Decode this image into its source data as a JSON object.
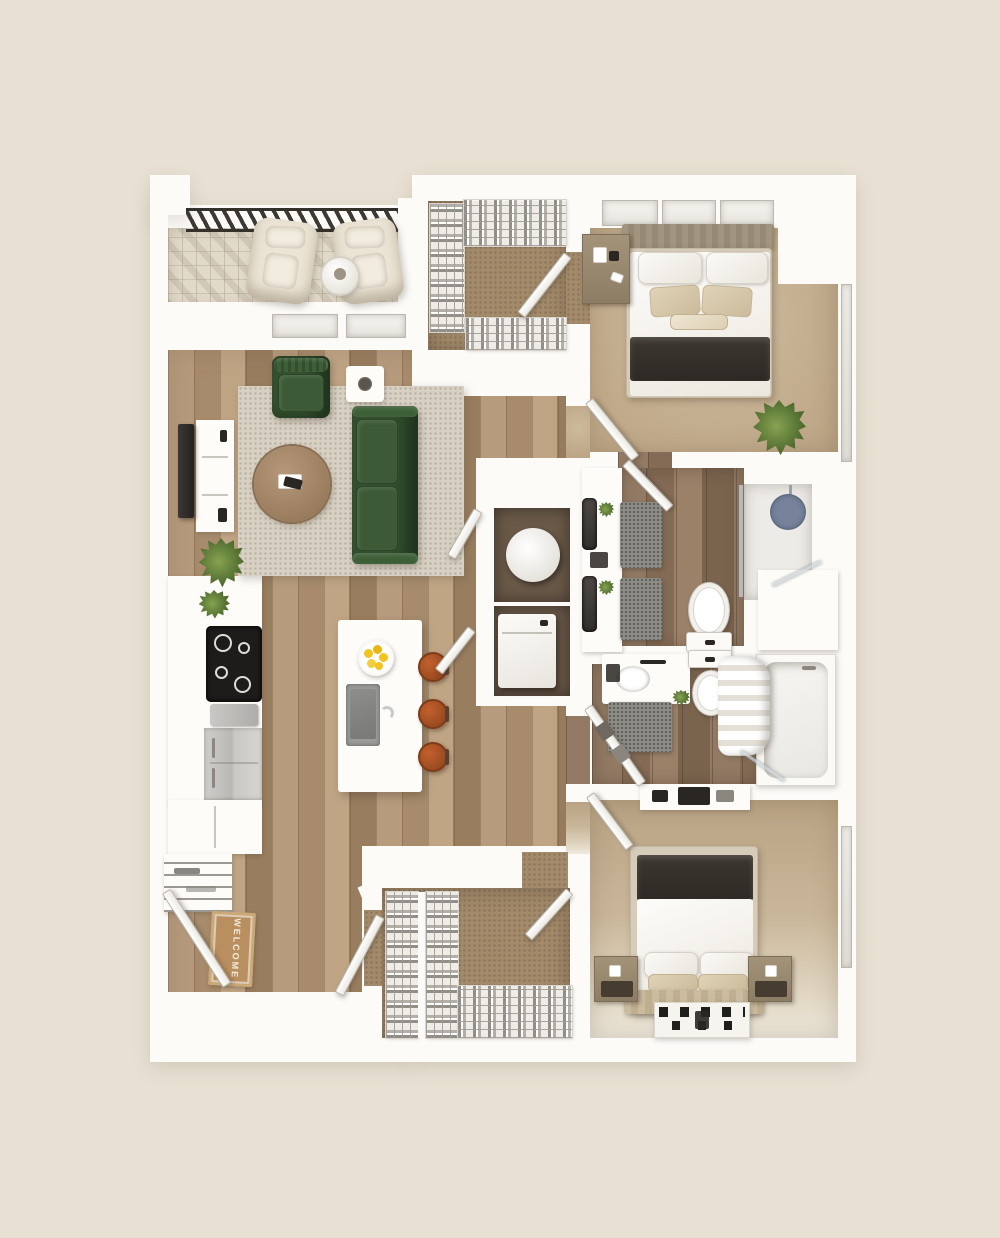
{
  "scene": {
    "type": "3d_floor_plan",
    "unit": "two-bedroom two-bath apartment with balcony"
  },
  "entry": {
    "mat_text": "WELCOME"
  },
  "palette": {
    "background": "#e8e1d3",
    "wall": "#fcfbf8",
    "wood_mid": "#ac9072",
    "tile_mid": "#8c7460",
    "balcony": "#e2dac9",
    "carpet_bed": "#bda686",
    "carpet_closet": "#a38a6b",
    "rug": "#d8d1c3",
    "sofa": "#33502f",
    "stool": "#9a4a20",
    "lemon": "#f1c41f",
    "blanket": "#2e2924",
    "mat_brown": "#b98f60",
    "mat_text": "#f3ecdb",
    "plant_dark": "#4f6b2e",
    "plant_light": "#86a352",
    "shower_mat": "#76839b",
    "steel": "#c6c5c2",
    "black": "#1d1c1a",
    "tv": "#26231f"
  },
  "rooms": [
    {
      "name": "balcony",
      "furniture": [
        "lounge chair",
        "lounge chair",
        "round patio table",
        "slatted railing"
      ]
    },
    {
      "name": "living room",
      "furniture": [
        "green sofa",
        "green armchair",
        "round coffee table",
        "area rug",
        "wall tv",
        "media console",
        "white side table",
        "floor plant"
      ]
    },
    {
      "name": "kitchen",
      "furniture": [
        "cooktop",
        "refrigerator",
        "base cabinets",
        "pantry shelves",
        "island with sink",
        "bowl of lemons",
        "bar stool",
        "bar stool",
        "bar stool"
      ]
    },
    {
      "name": "entry",
      "furniture": [
        "entry door",
        "welcome mat"
      ]
    },
    {
      "name": "laundry closet",
      "furniture": [
        "water heater",
        "washer dryer",
        "bifold doors"
      ]
    },
    {
      "name": "walk-in closet upper",
      "furniture": [
        "clothes racks",
        "door"
      ]
    },
    {
      "name": "bedroom 1",
      "furniture": [
        "bed with charcoal throw",
        "pillows",
        "nightstand",
        "plant",
        "windows",
        "door"
      ]
    },
    {
      "name": "bathroom 1",
      "furniture": [
        "vanity with dark sinks",
        "bath mat",
        "bath mat",
        "toilet",
        "glass shower",
        "shower mat",
        "bench"
      ]
    },
    {
      "name": "bathroom 2",
      "furniture": [
        "vanity",
        "toilet",
        "bath mat",
        "tub with shower curtain",
        "towel door"
      ]
    },
    {
      "name": "walk-in closet lower",
      "furniture": [
        "clothes racks",
        "doors"
      ]
    },
    {
      "name": "bedroom 2",
      "furniture": [
        "bed with charcoal throw",
        "nightstand",
        "nightstand",
        "dresser",
        "black and white rug",
        "window",
        "door"
      ]
    }
  ]
}
